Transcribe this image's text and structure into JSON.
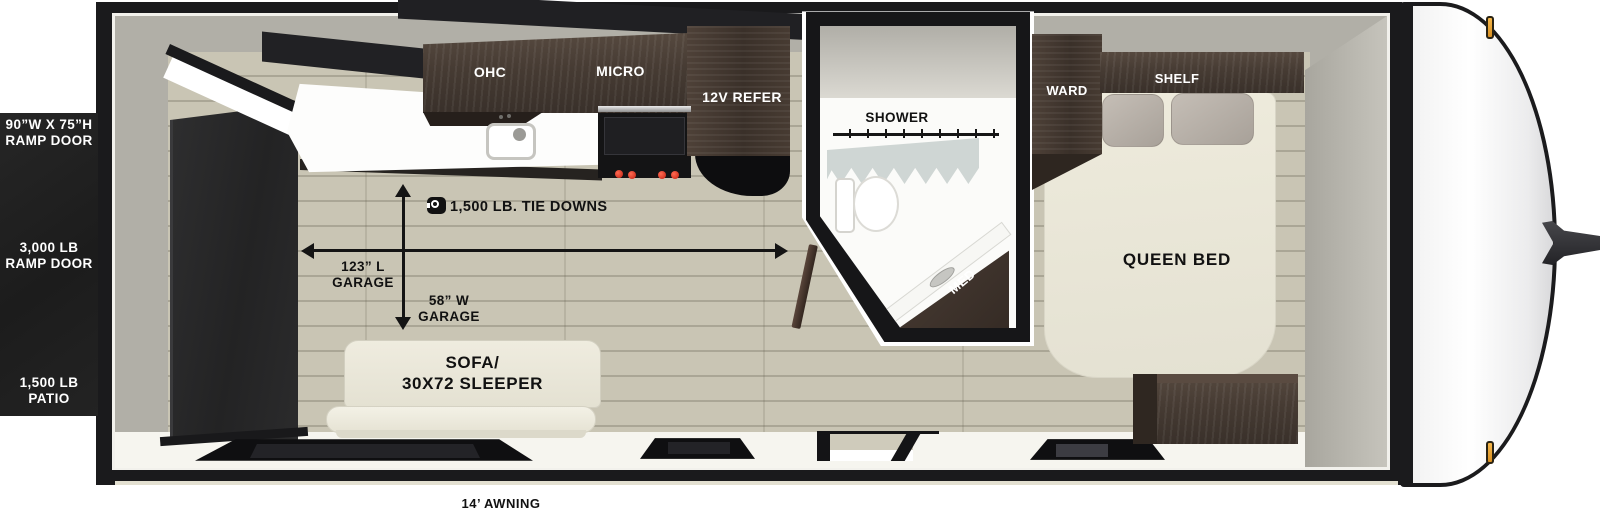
{
  "title": "Toy hauler travel trailer floorplan",
  "colors": {
    "frame_black": "#1a1a1c",
    "interior_wall_gray": "#b1afa7",
    "floor_tan": "#c9c5b4",
    "cabinet_wood": "#463b33",
    "upholstery_cream": "#eae7da",
    "marker_light_amber": "#e8a43c",
    "burner_red": "#c2210f",
    "curtain_gray_blue": "#cfd6d4"
  },
  "exterior": {
    "ramp_door_size": [
      "90”W X 75”H",
      "RAMP DOOR"
    ],
    "ramp_door_weight": [
      "3,000 LB",
      "RAMP DOOR"
    ],
    "patio": [
      "1,500 LB",
      "PATIO"
    ],
    "awning": "14’ AWNING"
  },
  "kitchen": {
    "ohc": "OHC",
    "micro": "MICRO",
    "refer": "12V REFER"
  },
  "garage": {
    "tie_downs": "1,500 LB. TIE DOWNS",
    "length": [
      "123” L",
      "GARAGE"
    ],
    "width": [
      "58” W",
      "GARAGE"
    ],
    "sofa": [
      "SOFA/",
      "30X72 SLEEPER"
    ]
  },
  "bathroom": {
    "shower": "SHOWER",
    "med": "MED"
  },
  "bedroom": {
    "ward": "WARD",
    "shelf": "SHELF",
    "bed": "QUEEN BED"
  }
}
